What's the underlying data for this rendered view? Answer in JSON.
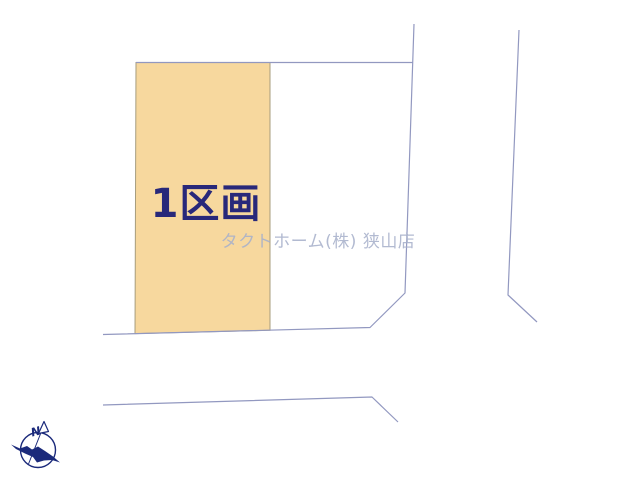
{
  "page": {
    "background": "#ffffff"
  },
  "diagram": {
    "lot1": {
      "label": "1区画",
      "fill": "#f7d89e",
      "border": "#a79d7d",
      "label_color": "#28287a"
    },
    "watermark": {
      "text": "タクトホーム(株) 狭山店",
      "color": "#a8b1cb"
    },
    "roads": {
      "line_color": "#9298c0"
    },
    "compass": {
      "icon": "compass-north-arrow",
      "north_label": "N",
      "color": "#1b2a7b"
    }
  }
}
